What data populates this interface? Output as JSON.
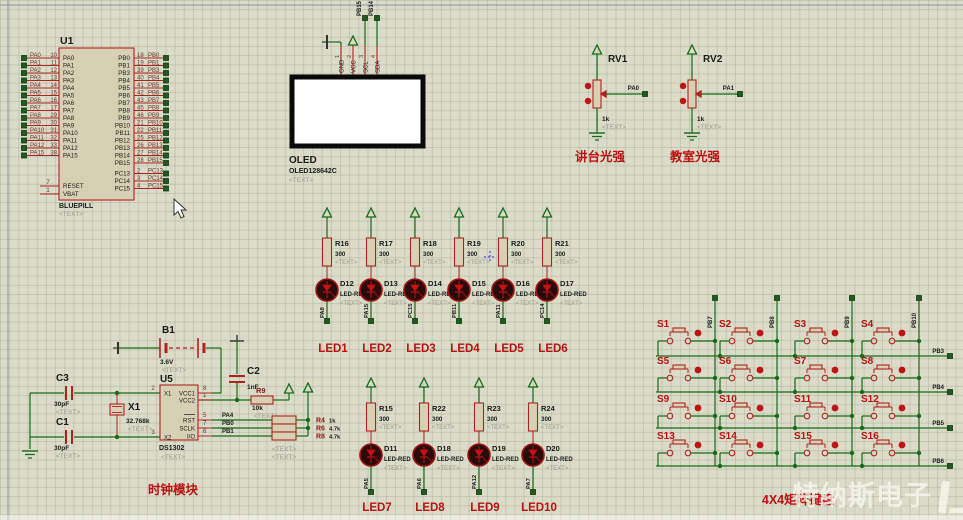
{
  "watermark": {
    "text": "特纳斯电子"
  },
  "u1": {
    "ref": "U1",
    "part": "BLUEPILL",
    "text": "<TEXT>",
    "left_pins": [
      {
        "net": "PA0",
        "num": "10",
        "name": "PA0"
      },
      {
        "net": "PA1",
        "num": "11",
        "name": "PA1"
      },
      {
        "net": "PA2",
        "num": "12",
        "name": "PA2"
      },
      {
        "net": "PA3",
        "num": "13",
        "name": "PA3"
      },
      {
        "net": "PA4",
        "num": "14",
        "name": "PA4"
      },
      {
        "net": "PA5",
        "num": "15",
        "name": "PA5"
      },
      {
        "net": "PA6",
        "num": "16",
        "name": "PA6"
      },
      {
        "net": "PA7",
        "num": "17",
        "name": "PA7"
      },
      {
        "net": "PA8",
        "num": "29",
        "name": "PA8"
      },
      {
        "net": "PA9",
        "num": "30",
        "name": "PA9"
      },
      {
        "net": "PA10",
        "num": "31",
        "name": "PA10"
      },
      {
        "net": "PA11",
        "num": "32",
        "name": "PA11"
      },
      {
        "net": "PA12",
        "num": "33",
        "name": "PA12"
      },
      {
        "net": "PA15",
        "num": "38",
        "name": "PA15"
      }
    ],
    "right_pins": [
      {
        "net": "PB0",
        "num": "18",
        "name": "PB0"
      },
      {
        "net": "PB1",
        "num": "19",
        "name": "PB1"
      },
      {
        "net": "PB3",
        "num": "39",
        "name": "PB3"
      },
      {
        "net": "PB4",
        "num": "40",
        "name": "PB4"
      },
      {
        "net": "PB5",
        "num": "41",
        "name": "PB5"
      },
      {
        "net": "PB6",
        "num": "42",
        "name": "PB6"
      },
      {
        "net": "PB7",
        "num": "43",
        "name": "PB7"
      },
      {
        "net": "PB8",
        "num": "45",
        "name": "PB8"
      },
      {
        "net": "PB9",
        "num": "46",
        "name": "PB9"
      },
      {
        "net": "PB10",
        "num": "21",
        "name": "PB10"
      },
      {
        "net": "PB11",
        "num": "22",
        "name": "PB11"
      },
      {
        "net": "PB12",
        "num": "25",
        "name": "PB12"
      },
      {
        "net": "PB13",
        "num": "26",
        "name": "PB13"
      },
      {
        "net": "PB14",
        "num": "27",
        "name": "PB14"
      },
      {
        "net": "PB15",
        "num": "28",
        "name": "PB15"
      }
    ],
    "pc_pins": [
      {
        "net": "PC13",
        "num": "2",
        "name": "PC13"
      },
      {
        "net": "PC14",
        "num": "3",
        "name": "PC14"
      },
      {
        "net": "PC15",
        "num": "4",
        "name": "PC15"
      }
    ],
    "bottom_pins": [
      {
        "name": "RESET",
        "num": "7"
      },
      {
        "name": "VBAT",
        "num": "1"
      }
    ]
  },
  "oled": {
    "ref": "OLED",
    "part": "OLED128642C",
    "text": "<TEXT>",
    "pins": [
      {
        "num": "1",
        "name": "GND"
      },
      {
        "num": "2",
        "name": "VCC"
      },
      {
        "num": "3",
        "name": "SCL"
      },
      {
        "num": "4",
        "name": "SDA"
      }
    ],
    "net_scl": "PB15",
    "net_sda": "PB14"
  },
  "pots": [
    {
      "ref": "RV1",
      "value": "1k",
      "text": "<TEXT>",
      "net": "PA0",
      "caption": "讲台光强"
    },
    {
      "ref": "RV2",
      "value": "1k",
      "text": "<TEXT>",
      "net": "PA1",
      "caption": "教室光强"
    }
  ],
  "led_top": [
    {
      "res": "R16",
      "val": "300",
      "led": "D12",
      "part": "LED-RED",
      "net": "PA8",
      "cap": "LED1",
      "text": "<TEXT>"
    },
    {
      "res": "R17",
      "val": "300",
      "led": "D13",
      "part": "LED-RED",
      "net": "PA15",
      "cap": "LED2",
      "text": "<TEXT>"
    },
    {
      "res": "R18",
      "val": "300",
      "led": "D14",
      "part": "LED-RED",
      "net": "PC15",
      "cap": "LED3",
      "text": "<TEXT>"
    },
    {
      "res": "R19",
      "val": "300",
      "led": "D15",
      "part": "LED-RED",
      "net": "PB11",
      "cap": "LED4",
      "text": "<TEXT>"
    },
    {
      "res": "R20",
      "val": "300",
      "led": "D16",
      "part": "LED-RED",
      "net": "PA11",
      "cap": "LED5",
      "text": "<TEXT>"
    },
    {
      "res": "R21",
      "val": "300",
      "led": "D17",
      "part": "LED-RED",
      "net": "PC14",
      "cap": "LED6",
      "text": "<TEXT>"
    }
  ],
  "led_bottom": [
    {
      "res": "R15",
      "val": "300",
      "led": "D11",
      "part": "LED-RED",
      "net": "PA5",
      "cap": "LED7",
      "text": "<TEXT>"
    },
    {
      "res": "R22",
      "val": "300",
      "led": "D18",
      "part": "LED-RED",
      "net": "PA6",
      "cap": "LED8",
      "text": "<TEXT>"
    },
    {
      "res": "R23",
      "val": "300",
      "led": "D19",
      "part": "LED-RED",
      "net": "PA12",
      "cap": "LED9",
      "text": "<TEXT>"
    },
    {
      "res": "R24",
      "val": "300",
      "led": "D20",
      "part": "LED-RED",
      "net": "PA7",
      "cap": "LED10",
      "text": "<TEXT>"
    }
  ],
  "clock": {
    "caption": "时钟模块",
    "b1": {
      "ref": "B1",
      "value": "3.6V",
      "text": "<TEXT>"
    },
    "c1": {
      "ref": "C1",
      "value": "30pF",
      "text": "<TEXT>"
    },
    "c2": {
      "ref": "C2",
      "value": "1nF"
    },
    "c3": {
      "ref": "C3",
      "value": "30pF",
      "text": "<TEXT>"
    },
    "r9": {
      "ref": "R9",
      "value": "10k",
      "text": "<TEXT>"
    },
    "x1": {
      "ref": "X1",
      "value": "32.768k",
      "text": "<TEXT>"
    },
    "u5": {
      "ref": "U5",
      "part": "DS1302",
      "text": "<TEXT>",
      "pins_left": [
        {
          "num": "2",
          "name": "X1"
        },
        {
          "num": "3",
          "name": "X2"
        }
      ],
      "pins_right": [
        {
          "num": "8",
          "name": "VCC1"
        },
        {
          "num": "1",
          "name": "VCC2"
        },
        {
          "num": "5",
          "name": "RST"
        },
        {
          "num": "7",
          "name": "SCLK"
        },
        {
          "num": "6",
          "name": "I/O"
        }
      ]
    },
    "pullups": [
      {
        "ref": "R4",
        "value": "1k"
      },
      {
        "ref": "R6",
        "value": "4.7k"
      },
      {
        "ref": "R8",
        "value": "4.7k"
      }
    ],
    "pullup_texts": [
      "<TEXT>",
      "<TEXT>"
    ],
    "nets": [
      "PA4",
      "PB0",
      "PB1"
    ]
  },
  "keypad": {
    "caption": "4X4矩阵键盘",
    "col_nets": [
      "PB7",
      "PB8",
      "PB9",
      "PB10"
    ],
    "row_nets": [
      "PB3",
      "PB4",
      "PB5",
      "PB6"
    ],
    "keys": [
      "S1",
      "S2",
      "S3",
      "S4",
      "S5",
      "S6",
      "S7",
      "S8",
      "S9",
      "S10",
      "S11",
      "S12",
      "S13",
      "S14",
      "S15",
      "S16"
    ]
  }
}
